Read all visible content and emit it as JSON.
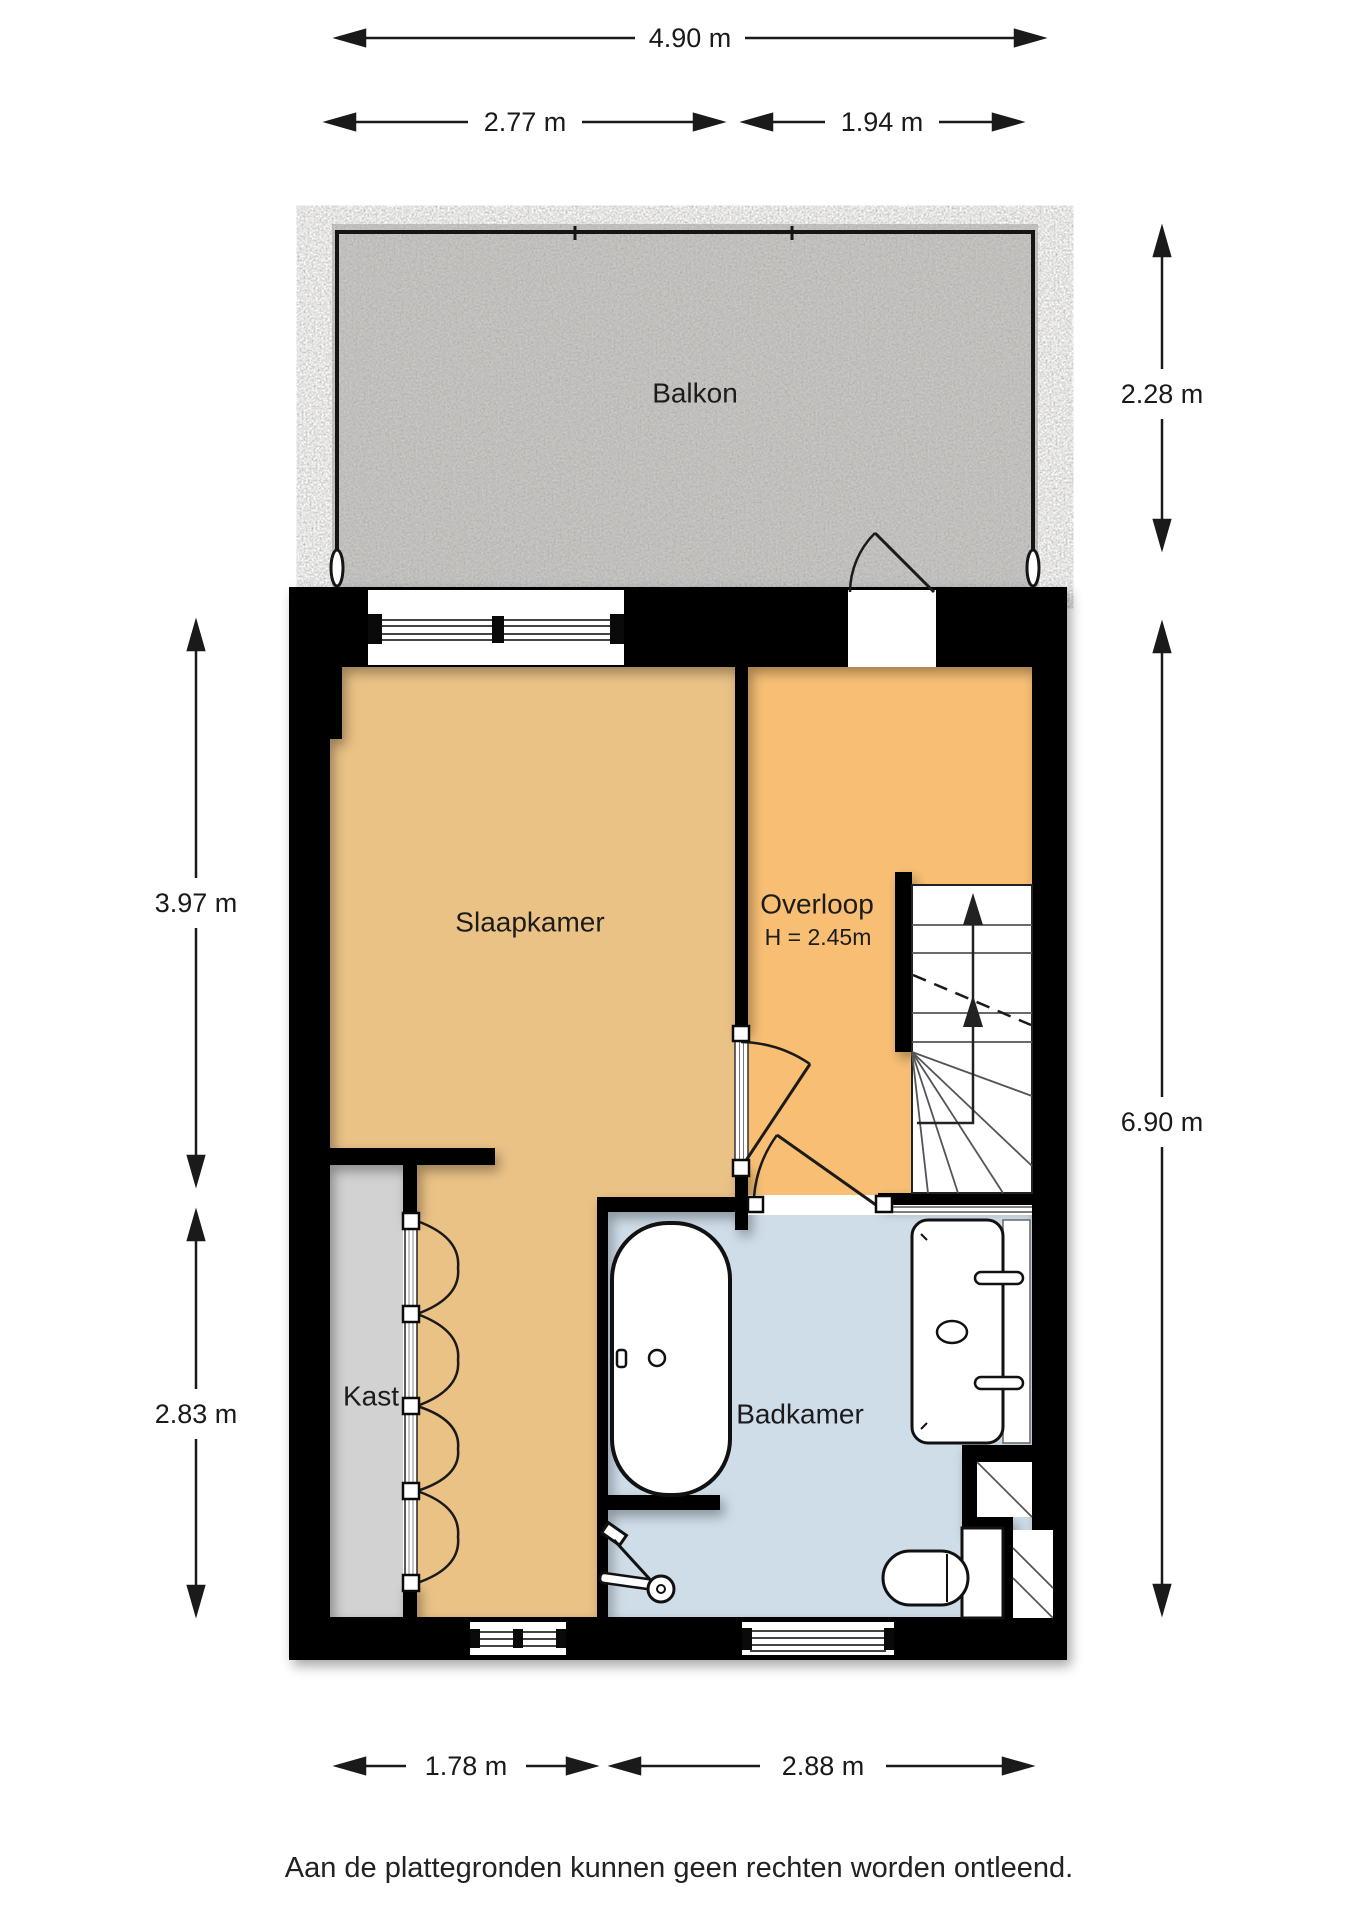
{
  "floorplan": {
    "rooms": {
      "balkon": {
        "label": "Balkon"
      },
      "slaapkamer": {
        "label": "Slaapkamer"
      },
      "overloop": {
        "label": "Overloop",
        "height_note": "H = 2.45m"
      },
      "kast": {
        "label": "Kast"
      },
      "badkamer": {
        "label": "Badkamer"
      }
    },
    "dimensions": {
      "top_total": {
        "label": "4.90 m"
      },
      "top_left": {
        "label": "2.77 m"
      },
      "top_right": {
        "label": "1.94 m"
      },
      "right_balcony": {
        "label": "2.28 m"
      },
      "right_interior": {
        "label": "6.90 m"
      },
      "left_upper": {
        "label": "3.97 m"
      },
      "left_lower": {
        "label": "2.83 m"
      },
      "bottom_left": {
        "label": "1.78 m"
      },
      "bottom_right": {
        "label": "2.88 m"
      }
    },
    "colors": {
      "bedroom": "#ebc286",
      "overloop": "#f8bf74",
      "bathroom": "#cfdde9",
      "closet": "#d2d2d2",
      "balcony": "#cac9c7",
      "wall": "#050505",
      "background": "#ffffff"
    }
  },
  "footer": {
    "disclaimer": "Aan de plattegronden kunnen geen rechten worden ontleend."
  }
}
